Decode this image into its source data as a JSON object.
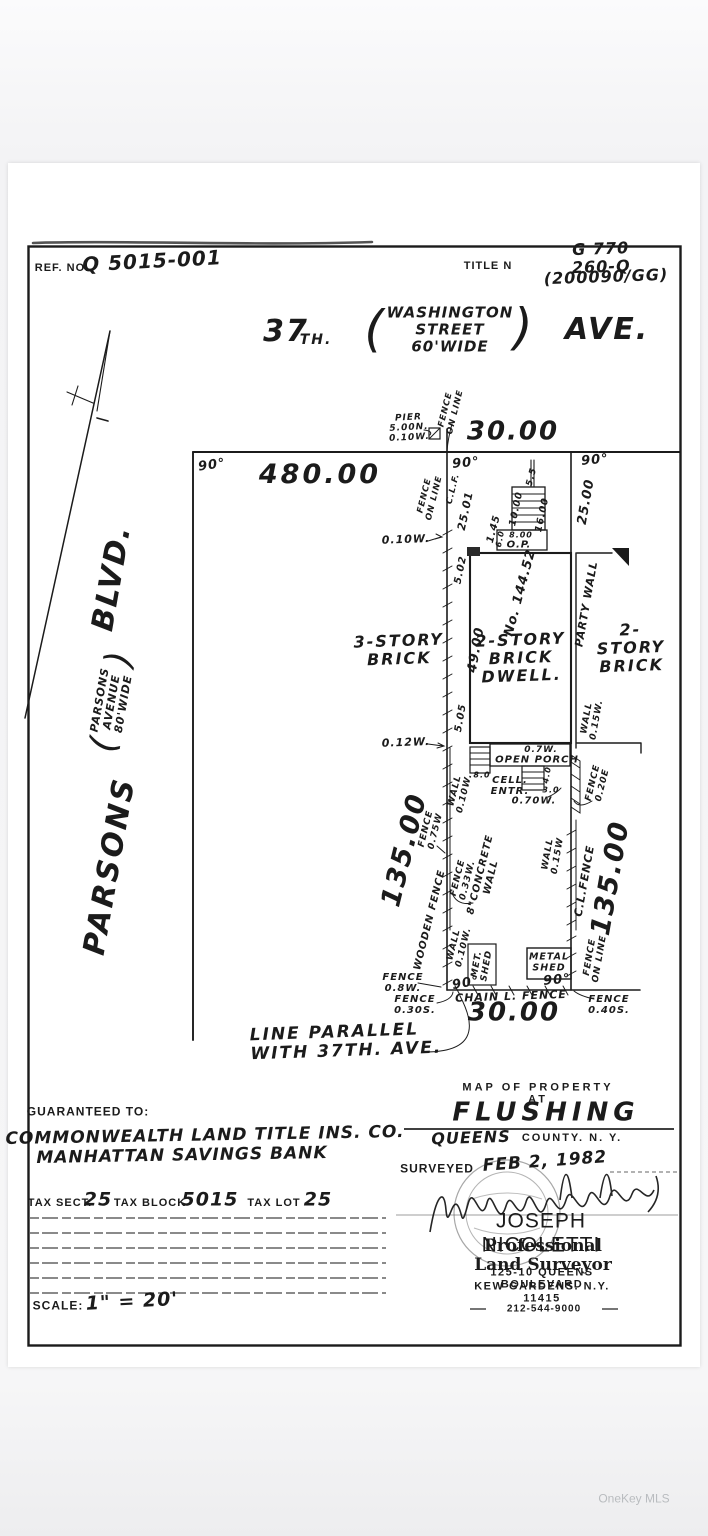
{
  "colors": {
    "ink": "#1b1b1b",
    "paper": "#ffffff",
    "background": "#f6f6f7",
    "watermark": "#b9bcbf"
  },
  "watermark": "OneKey MLS",
  "header": {
    "ref_label": "REF. NO.",
    "ref_value": "Q 5015-001",
    "title_label": "TITLE N",
    "title_value_line1": "G 770 260-Q",
    "title_value_line2": "(200090/GG)"
  },
  "street_top": {
    "num": "37",
    "num_suffix": "TH.",
    "paren_open": "(",
    "paren_lines": "WASHINGTON\nSTREET\n60'WIDE",
    "paren_close": ")",
    "name_right": "AVE."
  },
  "street_left": {
    "main": "PARSONS",
    "paren_open": "(",
    "paren_lines": "PARSONS\nAVENUE\n80'WIDE",
    "paren_close": ")",
    "suffix": "BLVD."
  },
  "plot": {
    "angle": "90°",
    "pier": "PIER\n5.00N.\n0.10W.",
    "fence_on_line_top": "FENCE\nON LINE",
    "front_dim": "30.00",
    "to_parsons_dim": "480.00",
    "fence_on_line_west": "FENCE\nON LINE",
    "clf_top": "C.L.F.",
    "dim_2501": "25.01",
    "dim_2500": "25.00",
    "dim_55": "5.5",
    "dim_1000": "10.00",
    "dim_1600": "16.00",
    "dim_800": "8.00",
    "op": "O.P.",
    "dim_60": "6.0",
    "dim_145": "1.45",
    "fence_010w_top": "0.10W.",
    "dim_502": "5.02",
    "house_no": "No. 144.52",
    "dim_4900": "49.00",
    "bldg_left": "3-STORY\nBRICK",
    "bldg_center": "2-STORY\nBRICK\nDWELL.",
    "party_wall": "PARTY WALL",
    "bldg_right": "2-STORY\nBRICK",
    "wall_015w_right": "WALL\n0.15W.",
    "dim_505": "5.05",
    "dim_012w": "0.12W.",
    "dim_07w": "0.7W.",
    "open_porch": "OPEN PORCH",
    "dim_80": "8.0",
    "cell_entr": "CELL.\nENTR.",
    "dim_40": "4.0",
    "dim_30": "3.0",
    "dim_070w": "0.70W.",
    "fence_020e": "FENCE\n0.20E",
    "wall_010w_mid": "WALL\n0.10W.",
    "fence_075w": "FENCE\n0.75W",
    "west_dim": "135.00",
    "fence_033w": "FENCE\n0.33W.",
    "concrete_wall": "8\"CONCRETE\nWALL",
    "wooden_fence": "WOODEN FENCE",
    "wall_010w_low": "WALL\n0.10W.",
    "met_shed": "MET.\nSHED",
    "metal_shed": "METAL\nSHED",
    "fence_08w": "FENCE\n0.8W.",
    "fence_030s": "FENCE\n0.30S.",
    "chain_l_fence": "CHAIN L. FENCE",
    "rear_dim": "30.00",
    "fence_040s": "FENCE\n0.40S.",
    "wall_015w_east": "WALL\n0.15W",
    "cl_fence": "C.L.FENCE",
    "east_dim": "135.00",
    "fence_on_line_east": "FENCE\nON LINE",
    "line_parallel": "LINE PARALLEL\nWITH 37TH. AVE."
  },
  "footer_left": {
    "guaranteed_label": "GUARANTEED TO:",
    "guaranteed_line1": "COMMONWEALTH LAND TITLE INS. CO.",
    "guaranteed_line2": "MANHATTAN SAVINGS BANK",
    "tax_sect_label": "TAX SECT.",
    "tax_sect_value": "25",
    "tax_block_label": "TAX BLOCK",
    "tax_block_value": "5015",
    "tax_lot_label": "TAX LOT",
    "tax_lot_value": "25",
    "scale_label": "SCALE:",
    "scale_value": "1\" = 20'"
  },
  "footer_right": {
    "map_of": "MAP OF PROPERTY AT",
    "city": "FLUSHING",
    "county_hand": "QUEENS",
    "county_rest": "COUNTY. N. Y.",
    "surveyed_label": "SURVEYED",
    "surveyed_date": "FEB 2, 1982",
    "surveyor_name": "JOSEPH NICOLETTI",
    "surveyor_title": "Professional Land Surveyor",
    "address_line1": "125-10 QUEENS BOULEVARD",
    "address_line2": "KEW GARDENS. N.Y. 11415",
    "phone": "212-544-9000"
  }
}
